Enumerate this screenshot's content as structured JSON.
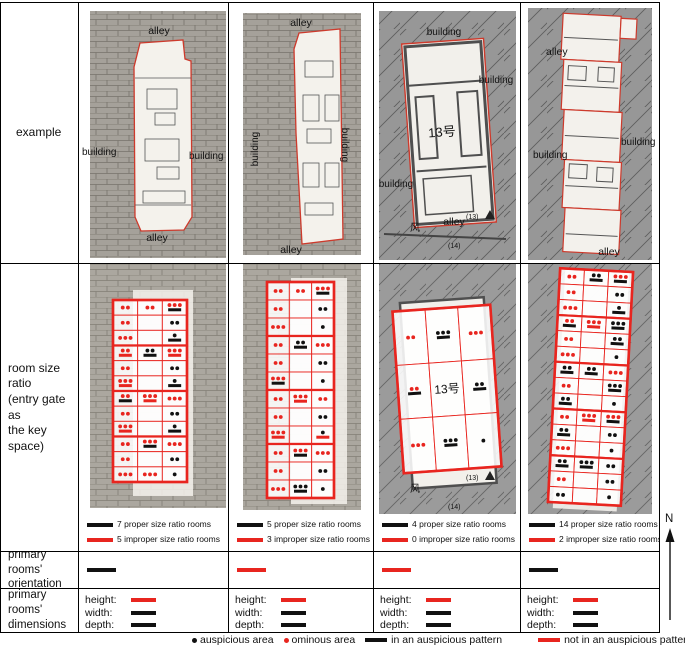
{
  "colors": {
    "red": "#e8251f",
    "black": "#111111",
    "plan_outline": "#cd3a2c",
    "map_gray": "#9b9b9b"
  },
  "row_labels": {
    "example": "example",
    "ratio_l1": "room size ratio",
    "ratio_l2": "(entry gate as",
    "ratio_l3": "the key space)",
    "orient_l1": "primary rooms'",
    "orient_l2": "orientation",
    "dims_l1": "primary rooms'",
    "dims_l2": "dimensions"
  },
  "compass": {
    "label": "N"
  },
  "legend": {
    "auspicious_area": "auspicious area",
    "ominous_area": "ominous area",
    "auspicious_pattern": "in an auspicious pattern",
    "not_auspicious_pattern": "not in an auspicious pattern"
  },
  "examples": [
    {
      "top": "alley",
      "left": "building",
      "right": "building",
      "bottom": "alley"
    },
    {
      "top": "alley",
      "left": "building",
      "right": "building",
      "bottom": "alley"
    },
    {
      "top": "building",
      "right": "building",
      "left": "building",
      "bottom": "alley",
      "unit": "13号",
      "marker": "(13)",
      "marker2": "(14)",
      "wind": "风"
    },
    {
      "top": "alley",
      "right": "building",
      "left": "building",
      "bottom": "alley"
    }
  ],
  "ratio_counts": [
    {
      "proper": "7 proper size ratio rooms",
      "improper": "5 improper size ratio rooms"
    },
    {
      "proper": "5 proper size ratio rooms",
      "improper": "3 improper size ratio rooms"
    },
    {
      "proper": "4 proper size ratio rooms",
      "improper": "0 improper size ratio rooms"
    },
    {
      "proper": "14 proper size ratio rooms",
      "improper": "2 improper size ratio rooms"
    }
  ],
  "orientations": [
    "black",
    "red",
    "red",
    "black"
  ],
  "dimension_labels": {
    "height": "height:",
    "width": "width:",
    "depth": "depth:"
  },
  "dimensions": [
    {
      "height": "red",
      "width": "black",
      "depth": "black"
    },
    {
      "height": "red",
      "width": "black",
      "depth": "black"
    },
    {
      "height": "red",
      "width": "black",
      "depth": "black"
    },
    {
      "height": "red",
      "width": "black",
      "depth": "black"
    }
  ],
  "ratio_grids": [
    {
      "x": 34,
      "y": 36,
      "w": 74,
      "h": 182,
      "rotate": 0,
      "sections": [
        [
          [
            "r2",
            "r2",
            "r3B"
          ],
          [
            "r2",
            "",
            "k2"
          ],
          [
            "r3",
            "",
            "k1B"
          ]
        ],
        [
          [
            "r2R",
            "k2B",
            "r3R"
          ],
          [
            "r2",
            "",
            "k2"
          ],
          [
            "r3R",
            "",
            "k1B"
          ]
        ],
        [
          [
            "r2B",
            "r3R",
            "r3"
          ],
          [
            "r2",
            "",
            "k2"
          ],
          [
            "r3R",
            "",
            "k1B"
          ]
        ],
        [
          [
            "r2",
            "r3B",
            "r3"
          ],
          [
            "r2",
            "",
            "k2"
          ],
          [
            "r3",
            "r3",
            "k1"
          ]
        ]
      ]
    },
    {
      "x": 38,
      "y": 18,
      "w": 67,
      "h": 216,
      "rotate": 0,
      "sections": [
        [
          [
            "r2",
            "r2",
            "r3B"
          ],
          [
            "r2",
            "",
            "k2"
          ],
          [
            "r3",
            "",
            "k1"
          ]
        ],
        [
          [
            "r2",
            "k2B",
            "r3"
          ],
          [
            "r2",
            "",
            "k2"
          ],
          [
            "r3B",
            "",
            "k1"
          ]
        ],
        [
          [
            "r2",
            "r3R",
            "r2"
          ],
          [
            "r2",
            "",
            "k2"
          ],
          [
            "r3R",
            "",
            "k1R"
          ]
        ],
        [
          [
            "r2",
            "r3B",
            "r3"
          ],
          [
            "r2",
            "",
            "k2"
          ],
          [
            "r3",
            "k3B",
            "k1"
          ]
        ]
      ]
    },
    {
      "x": 24,
      "y": 44,
      "w": 98,
      "h": 162,
      "rotate": -4,
      "center_text": "13号",
      "sections": [
        [
          [
            "r2",
            "k3B",
            "r3"
          ],
          [
            "r2B",
            "t",
            "k2B"
          ],
          [
            "r3",
            "k3B",
            "k1"
          ]
        ]
      ]
    },
    {
      "x": 33,
      "y": 6,
      "w": 73,
      "h": 234,
      "rotate": 3,
      "sections": [
        [
          [
            "r2",
            "k2B",
            "r3B"
          ],
          [
            "r2",
            "",
            "k2"
          ],
          [
            "r3",
            "",
            "k1B"
          ]
        ],
        [
          [
            "r2B",
            "r3R",
            "k3B"
          ],
          [
            "r2",
            "",
            "k2B"
          ],
          [
            "r3",
            "",
            "k1"
          ]
        ],
        [
          [
            "k2B",
            "k2B",
            "r3"
          ],
          [
            "r2",
            "",
            "k3B"
          ],
          [
            "k2B",
            "",
            "k1"
          ]
        ],
        [
          [
            "r2",
            "r3R",
            "r3B"
          ],
          [
            "k2B",
            "",
            "k2"
          ],
          [
            "r3",
            "",
            "k1"
          ]
        ],
        [
          [
            "k2B",
            "k3B",
            "k2"
          ],
          [
            "r2",
            "",
            "k2"
          ],
          [
            "k2",
            "",
            "k1"
          ]
        ]
      ]
    }
  ]
}
